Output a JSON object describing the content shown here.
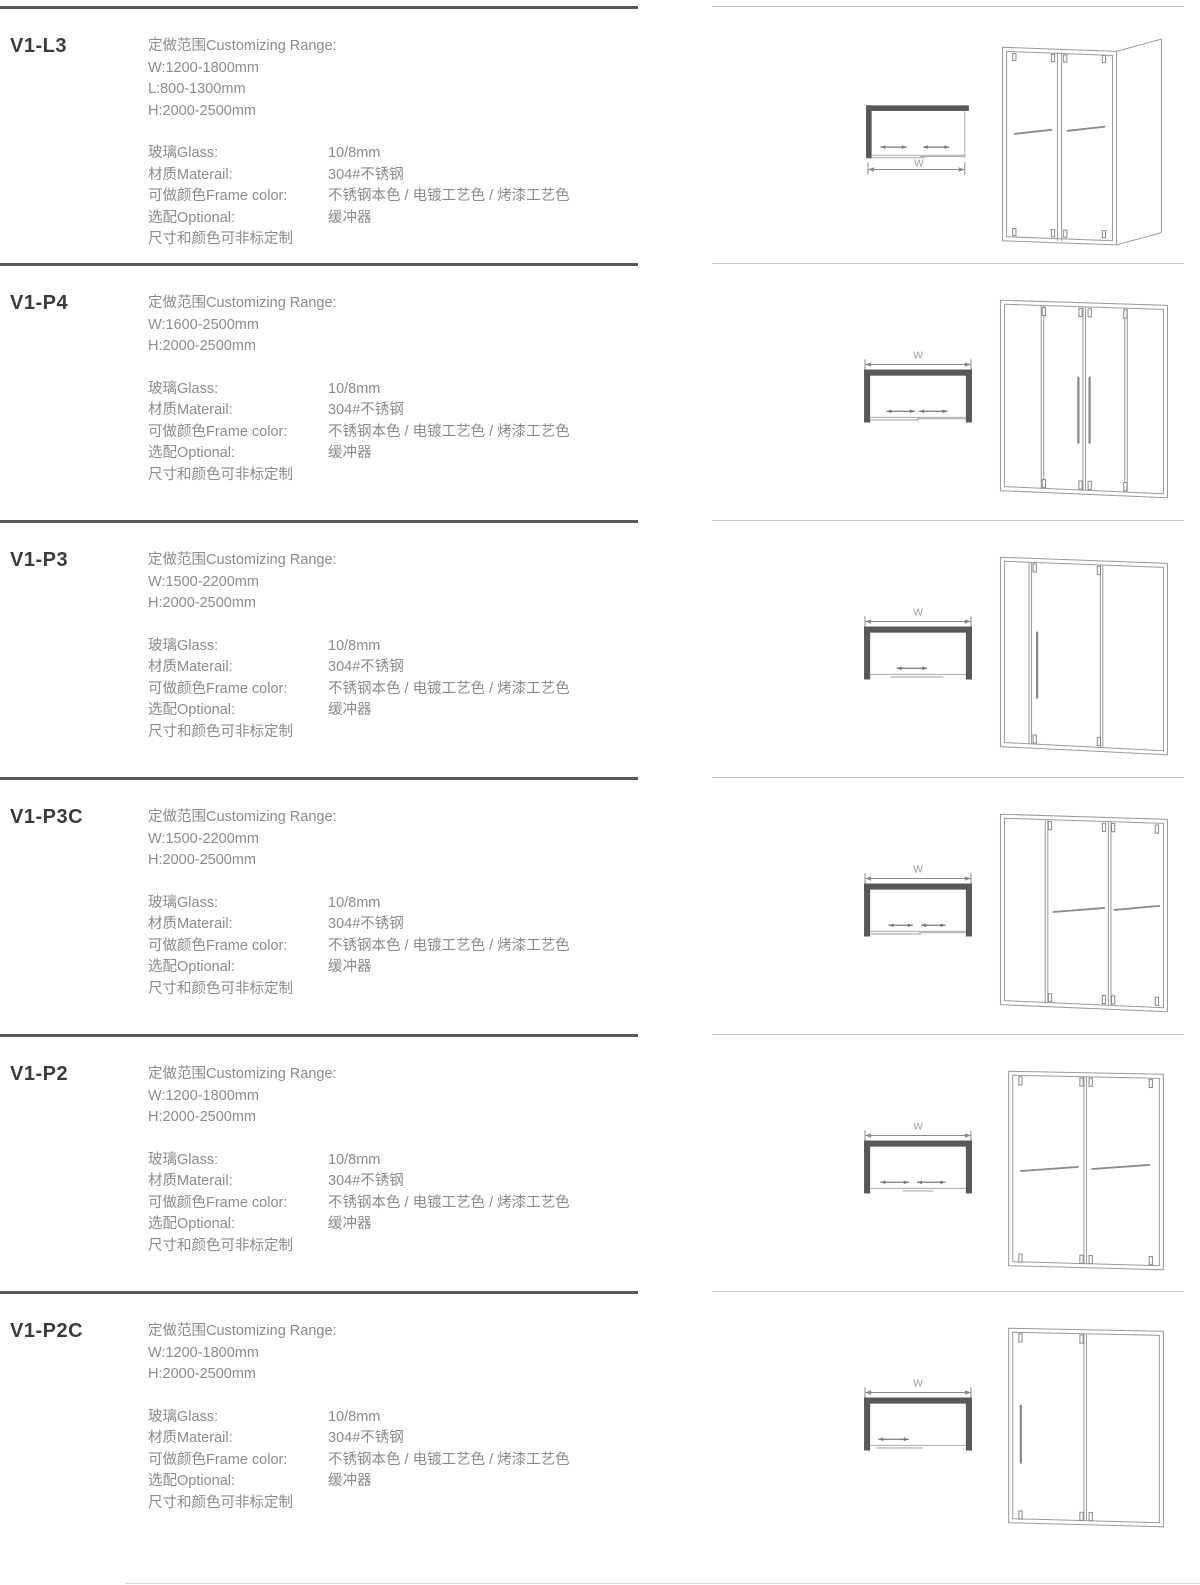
{
  "labels": {
    "range_title": "定做范围Customizing Range:",
    "glass": "玻璃Glass:",
    "material": "材质Materail:",
    "frame_color": "可做颜色Frame color:",
    "optional": "选配Optional:",
    "custom_note": "尺寸和颜色可非标定制",
    "w_label": "W"
  },
  "shared_specs": {
    "glass": "10/8mm",
    "material": "304#不锈钢",
    "frame_color": "不锈钢本色 / 电镀工艺色 / 烤漆工艺色",
    "optional": "缓冲器"
  },
  "colors": {
    "model_text": "#3b3b3b",
    "spec_text": "#8b8b8b",
    "left_divider": "#57575a",
    "right_divider": "#cbcbcb",
    "drawing_line": "#9b9b9b",
    "plan_wall": "#58585a"
  },
  "products": [
    {
      "model": "V1-L3",
      "range": [
        "W:1200-1800mm",
        "L:800-1300mm",
        "H:2000-2500mm"
      ]
    },
    {
      "model": "V1-P4",
      "range": [
        "W:1600-2500mm",
        "H:2000-2500mm"
      ]
    },
    {
      "model": "V1-P3",
      "range": [
        "W:1500-2200mm",
        "H:2000-2500mm"
      ]
    },
    {
      "model": "V1-P3C",
      "range": [
        "W:1500-2200mm",
        "H:2000-2500mm"
      ]
    },
    {
      "model": "V1-P2",
      "range": [
        "W:1200-1800mm",
        "H:2000-2500mm"
      ]
    },
    {
      "model": "V1-P2C",
      "range": [
        "W:1200-1800mm",
        "H:2000-2500mm"
      ]
    }
  ]
}
